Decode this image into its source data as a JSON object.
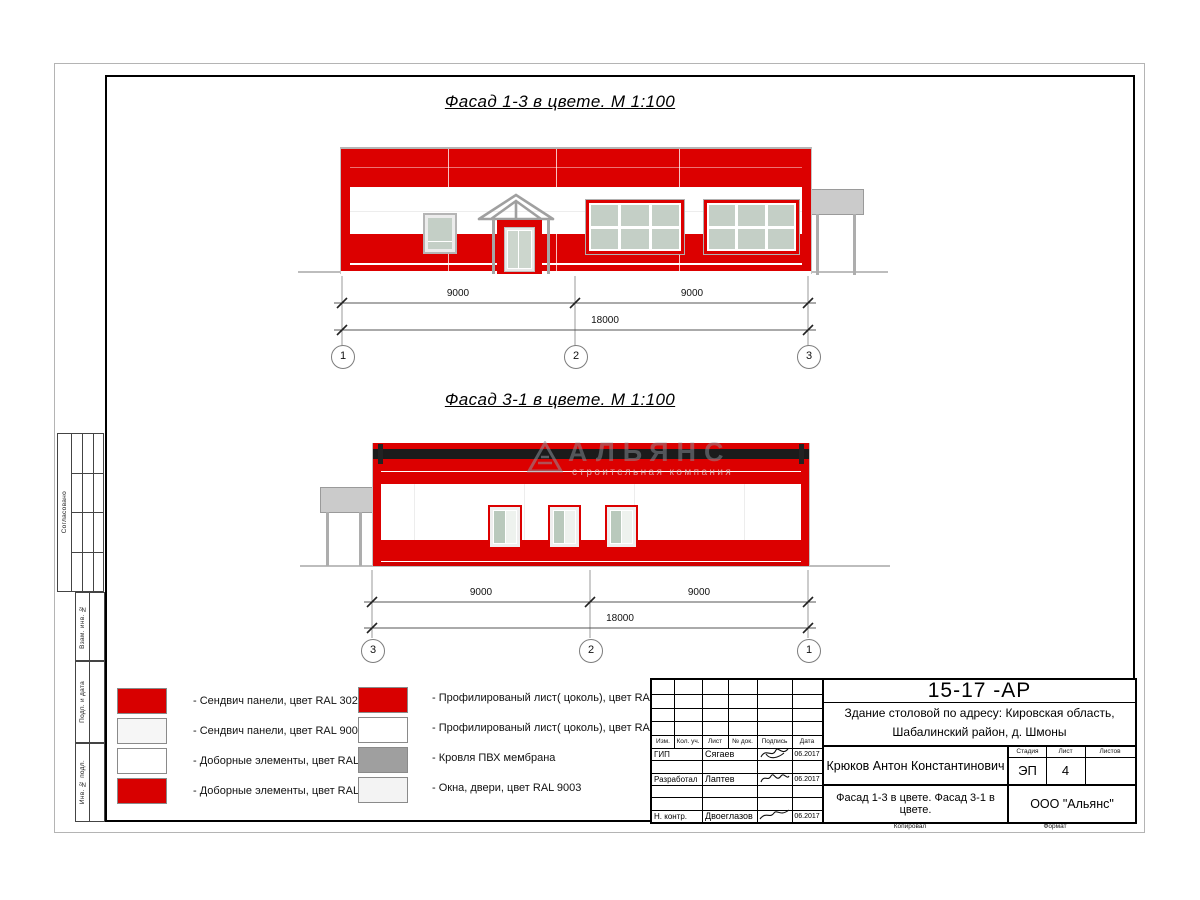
{
  "sheet": {
    "title_facade1": "Фасад 1-3 в цвете.  М 1:100",
    "title_facade2": "Фасад 3-1 в цвете.  М 1:100"
  },
  "watermark": {
    "name": "АЛЬЯНС",
    "tagline": "строительная компания"
  },
  "facade1": {
    "dim_left": "9000",
    "dim_right": "9000",
    "dim_total": "18000",
    "axis_left": "1",
    "axis_mid": "2",
    "axis_right": "3"
  },
  "facade2": {
    "dim_left": "9000",
    "dim_right": "9000",
    "dim_total": "18000",
    "axis_left": "3",
    "axis_mid": "2",
    "axis_right": "1"
  },
  "legend_left": {
    "items": [
      {
        "label": "- Сендвич панели, цвет RAL 3020",
        "swatch_color": "#d80000"
      },
      {
        "label": "- Сендвич панели, цвет RAL 9003",
        "swatch_color": "#f6f6f6"
      },
      {
        "label": "- Доборные элементы, цвет RAL 9003",
        "swatch_color": "#ffffff"
      },
      {
        "label": "- Доборные элементы, цвет RAL 3020",
        "swatch_color": "#d80000"
      }
    ]
  },
  "legend_right": {
    "items": [
      {
        "label": "- Профилированый лист( цоколь), цвет RAL 3020",
        "swatch_color": "#d80000"
      },
      {
        "label": "- Профилированый лист( цоколь), цвет RAL 9003",
        "swatch_color": "#ffffff"
      },
      {
        "label": "- Кровля ПВХ мембрана",
        "swatch_color": "#9f9f9f"
      },
      {
        "label": "- Окна, двери, цвет RAL 9003",
        "swatch_color": "#f3f3f3"
      }
    ]
  },
  "side_stamps": {
    "agreed": "Согласовано",
    "box1": "Взам. инв. №",
    "box2": "Подп. и дата",
    "box3": "Инв. № подл."
  },
  "titleblock": {
    "doc_number": "15-17 -АР",
    "object_line1": "Здание столовой по адресу: Кировская область,",
    "object_line2": "Шабалинский район, д. Шмоны",
    "cols": {
      "c0": "Изм.",
      "c1": "Кол. уч.",
      "c2": "Лист",
      "c3": "№ док.",
      "c4": "Подпись",
      "c5": "Дата"
    },
    "rows": [
      {
        "role": "ГИП",
        "name": "Сягаев",
        "date": "06.2017"
      },
      {
        "role": "Разработал",
        "name": "Лаптев",
        "date": "06.2017"
      },
      {
        "role": "Н. контр.",
        "name": "Двоеглазов",
        "date": "06.2017"
      }
    ],
    "chief": "Крюков Антон Константинович",
    "stage_label": "Стадия",
    "sheet_label": "Лист",
    "sheets_label": "Листов",
    "stage": "ЭП",
    "sheet_no": "4",
    "sheets_total": "",
    "sheet_title": "Фасад 1-3 в цвете. Фасад 3-1 в цвете.",
    "company": "ООО \"Альянс\"",
    "copied": "Копировал",
    "format": "Формат"
  },
  "colors": {
    "facade_red": "#dc0000",
    "membrane_black": "#1b1b1b",
    "glass_green": "#c4cfc6",
    "ral3020_swatch": "#d80000",
    "ral9003_swatch": "#f6f6f6",
    "membrane_swatch": "#9f9f9f"
  }
}
